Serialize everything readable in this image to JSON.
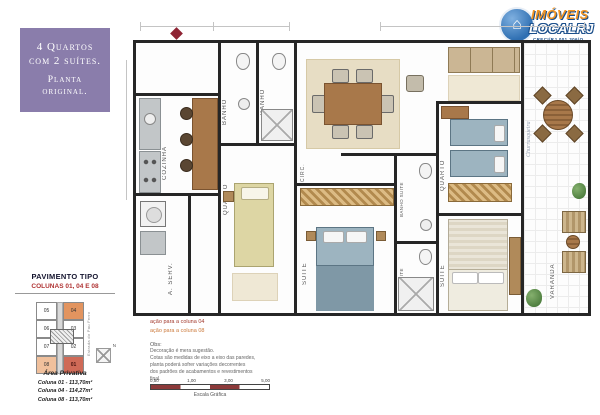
{
  "promo": {
    "lines": [
      "4 Quartos",
      "com 2 suítes.",
      "Planta",
      "original."
    ]
  },
  "logo": {
    "brand_top": "IMÓVEIS",
    "brand_bottom": "LOCALRJ",
    "creci": "CRECI/RJ 001.306/O",
    "globe_glyph": "⌂"
  },
  "plan": {
    "rooms": {
      "sala": "SALA",
      "cozinha": "COZINHA",
      "area_servico": "A. SERV.",
      "banho": "BANHO",
      "quarto": "QUARTO",
      "circ": "CIRC.",
      "suite": "SUITE",
      "banho_suite": "BANHO SUITE",
      "varanda": "VARANDA"
    },
    "annotations": {
      "churrasqueira": "Churrasqueira"
    }
  },
  "keyplan": {
    "title": "PAVIMENTO TIPO",
    "subtitle": "COLUNAS 01, 04 E 08",
    "street": "Estrada do Pau Ferro",
    "compass": "N",
    "units": [
      [
        "05",
        "04"
      ],
      [
        "06",
        "03"
      ],
      [
        "07",
        "02"
      ],
      [
        "08",
        "01"
      ]
    ],
    "highlighted_units": [
      "01",
      "04",
      "08"
    ]
  },
  "private_area": {
    "title": "Área Privativa",
    "lines": [
      "Coluna 01 - 113,70m²",
      "Coluna 04 - 114,27m²",
      "Coluna 08 - 113,70m²"
    ]
  },
  "legend": {
    "variation_col04": "ação para a coluna 04",
    "variation_col08": "ação para a coluna 08",
    "obs_title": "Obs:",
    "obs_lines": [
      "Decoração é mera sugestão.",
      "Cotas são medidas de eixo a eixo das paredes,",
      "planta poderá sofrer variações decorrentes",
      "dos padrões de acabamentos e revestimentos",
      "final."
    ],
    "scale_ticks": [
      "0,50",
      "1,00",
      "3,00",
      "5,00"
    ],
    "scale_caption": "Escala Gráfica"
  },
  "colors": {
    "promo_purple": "#8a7dab",
    "logo_orange": "#f29422",
    "logo_blue": "#1a4e8a",
    "unit_04": "#e2945f",
    "unit_08": "#f0c09c",
    "unit_01": "#cf6a57",
    "legend_col04": "#a33a2e",
    "legend_col08": "#cc7a3c",
    "scalebar_maroon": "#8c3a3a"
  }
}
